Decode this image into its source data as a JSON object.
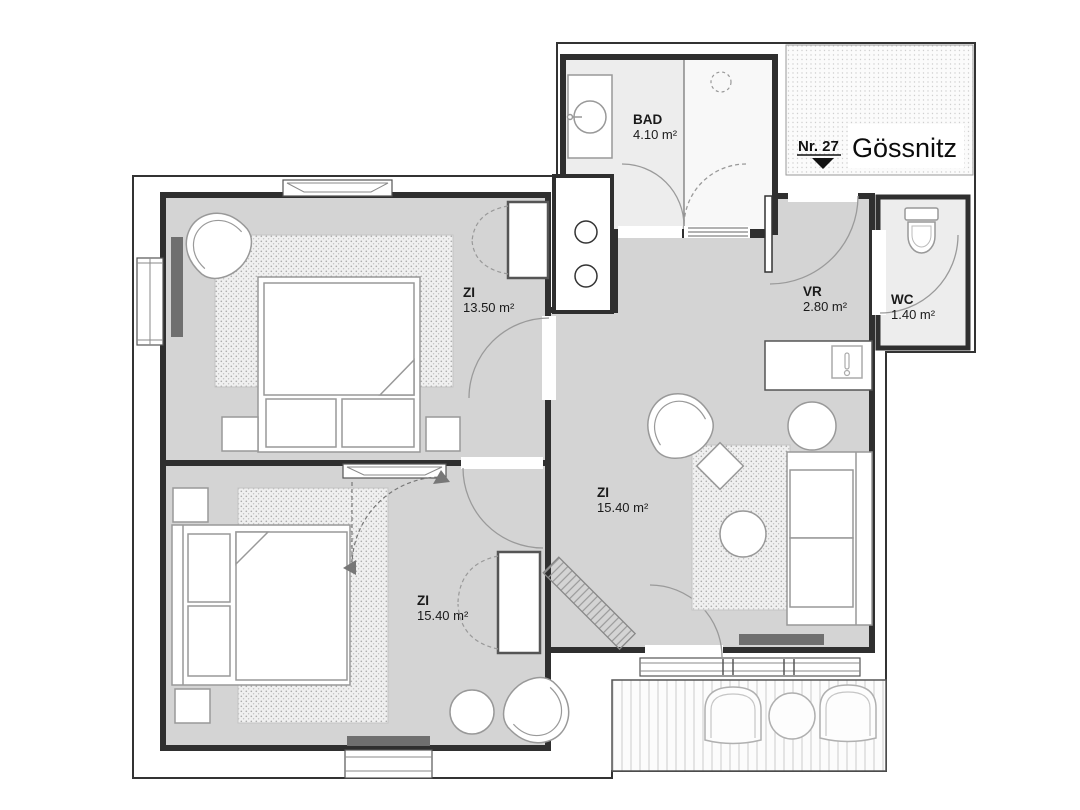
{
  "plan": {
    "unit_label": "Nr. 27",
    "building_name": "Gössnitz",
    "rooms": [
      {
        "id": "bad",
        "name": "BAD",
        "area": "4.10 m²"
      },
      {
        "id": "zi-top",
        "name": "ZI",
        "area": "13.50 m²"
      },
      {
        "id": "vr",
        "name": "VR",
        "area": "2.80 m²"
      },
      {
        "id": "wc",
        "name": "WC",
        "area": "1.40 m²"
      },
      {
        "id": "zi-living",
        "name": "ZI",
        "area": "15.40 m²"
      },
      {
        "id": "zi-bottom",
        "name": "ZI",
        "area": "15.40 m²"
      }
    ],
    "colors": {
      "room_fill": "#d4d4d4",
      "wet_room_fill": "#ededed",
      "wall": "#2f2f2f",
      "furniture_stroke": "#999999",
      "radiator": "#6f6f6f"
    }
  }
}
